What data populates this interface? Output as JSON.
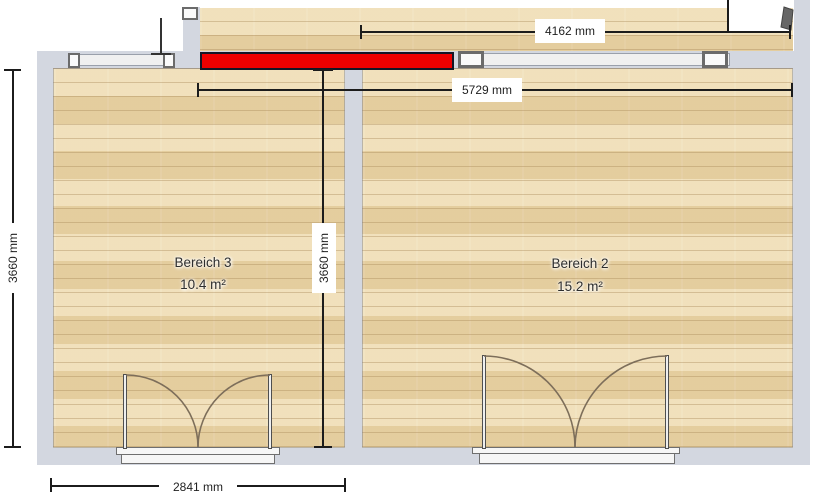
{
  "plan": {
    "rooms": [
      {
        "name": "Bereich 3",
        "area": "10.4 m²"
      },
      {
        "name": "Bereich 2",
        "area": "15.2 m²"
      }
    ],
    "dimensions": {
      "upper_room_width": "4162 mm",
      "top_width": "5729 mm",
      "left_height": "3660 mm",
      "inner_height": "3660 mm",
      "bottom_door_width": "2841 mm"
    },
    "colors": {
      "selected_element": "#ee0000",
      "wall": "#d3d7e0",
      "floor": "#ebd7aa",
      "dimension_line": "#1c1c1c",
      "window_glass": "#f0f0f0",
      "window_frame": "#6b6b6b",
      "door_arc": "#7d6e5a"
    },
    "icons": {
      "door_leaf_icon": "door-leaf",
      "window_bracket_icon": "window-end-bracket",
      "door_swing_icon": "double-door-swing"
    }
  }
}
